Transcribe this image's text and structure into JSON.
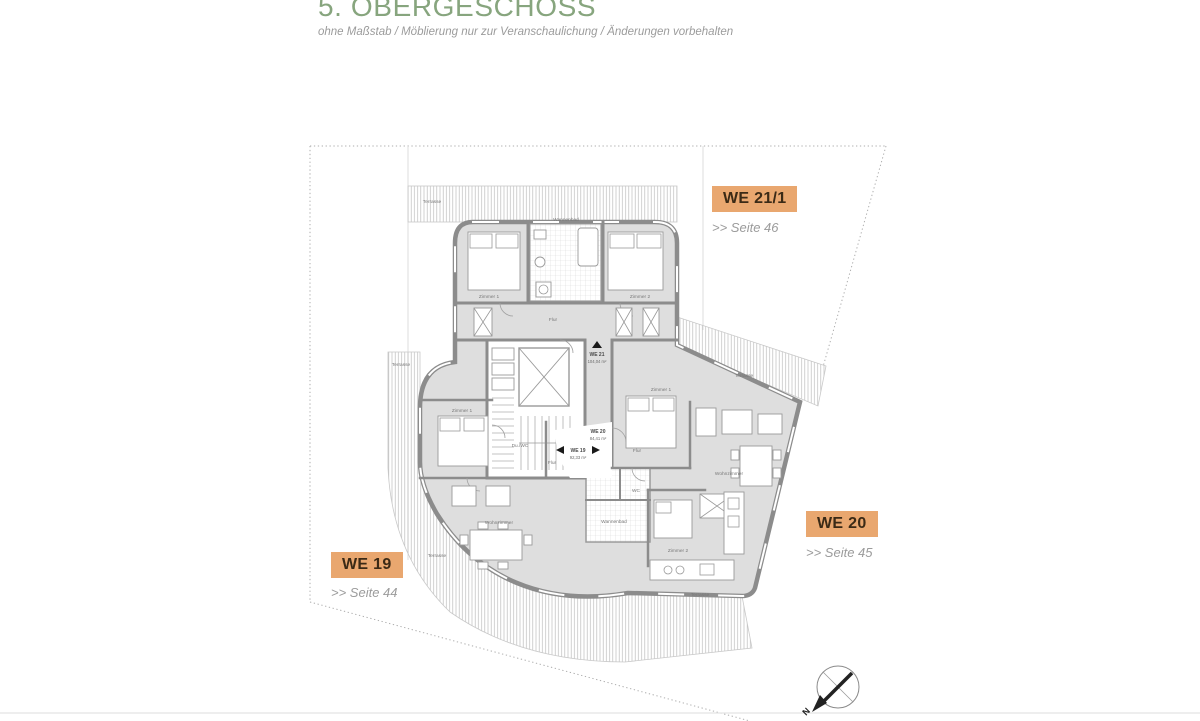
{
  "header": {
    "title": "5. OBERGESCHOSS",
    "subtitle": "ohne Maßstab / Möblierung nur zur Veranschaulichung / Änderungen vorbehalten"
  },
  "units": [
    {
      "label": "WE 19",
      "page_link": ">> Seite 44"
    },
    {
      "label": "WE 20",
      "page_link": ">> Seite 45"
    },
    {
      "label": "WE 21/1",
      "page_link": ">> Seite 46"
    }
  ],
  "plan": {
    "unit_tags": [
      {
        "name": "WE 21",
        "area": "104,04 m²"
      },
      {
        "name": "WE 19",
        "area": "92,33 m²"
      },
      {
        "name": "WE 20",
        "area": "84,41 m²"
      }
    ],
    "room_labels": [
      {
        "text": "Terrasse"
      },
      {
        "text": "Terrasse"
      },
      {
        "text": "Terrasse"
      },
      {
        "text": "Terrasse"
      },
      {
        "text": "Terrasse"
      },
      {
        "text": "Zimmer 1"
      },
      {
        "text": "Zimmer 2"
      },
      {
        "text": "Wannenbad"
      },
      {
        "text": "Flur"
      },
      {
        "text": "Zimmer 1"
      },
      {
        "text": "Du./WC"
      },
      {
        "text": "Flur"
      },
      {
        "text": "Wohnzimmer"
      },
      {
        "text": "Zimmer 1"
      },
      {
        "text": "Flur"
      },
      {
        "text": "Wohnzimmer"
      },
      {
        "text": "Zimmer 2"
      },
      {
        "text": "Wannenbad"
      },
      {
        "text": "WC"
      }
    ],
    "compass": {
      "north_label": "N"
    }
  },
  "colors": {
    "accent_green": "#87A57E",
    "label_orange": "#E9A76F",
    "label_text": "#3B2A16",
    "muted_gray": "#9B9B9B",
    "wall_gray": "#8C8C8C",
    "room_fill": "#DEDEDE"
  }
}
